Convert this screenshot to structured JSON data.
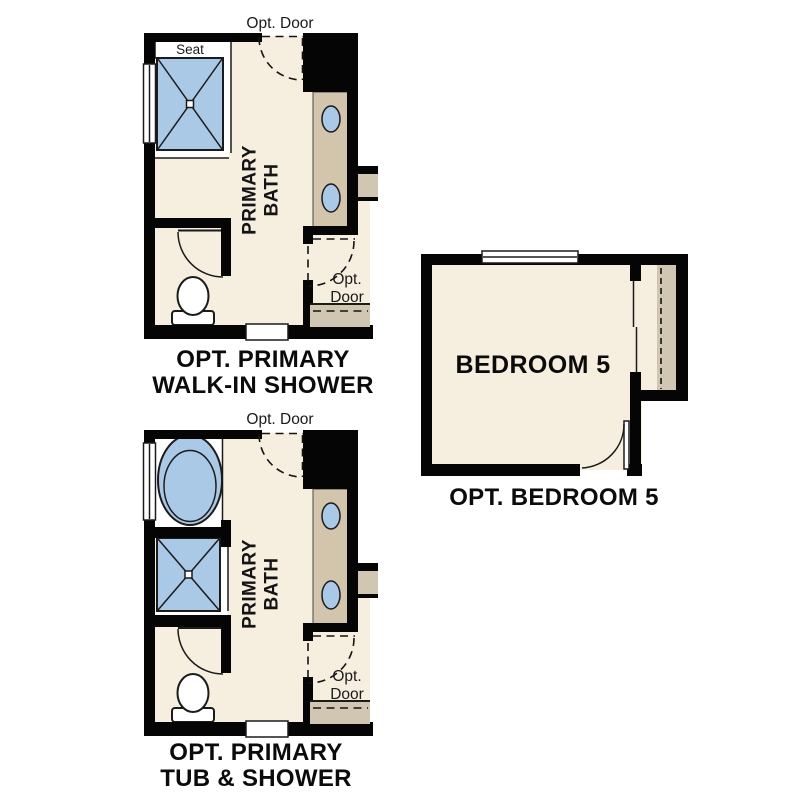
{
  "figure": {
    "type": "floor-plan-options",
    "background": "#ffffff"
  },
  "colors": {
    "wall": "#050505",
    "floor_cream": "#f6eedf",
    "fixture_blue": "#aac9e7",
    "counter_tan": "#d3c4ac",
    "closet_tan": "#d1c6b2",
    "fixture_white": "#ffffff"
  },
  "plans": {
    "walk_in_shower": {
      "caption": [
        "OPT. PRIMARY",
        "WALK-IN SHOWER"
      ],
      "room_label": [
        "PRIMARY",
        "BATH"
      ],
      "seat_label": "Seat",
      "opt_door_top_label": "Opt. Door",
      "opt_door_side_label": [
        "Opt.",
        "Door"
      ]
    },
    "tub_shower": {
      "caption": [
        "OPT. PRIMARY",
        "TUB & SHOWER"
      ],
      "room_label": [
        "PRIMARY",
        "BATH"
      ],
      "opt_door_top_label": "Opt. Door",
      "opt_door_side_label": [
        "Opt.",
        "Door"
      ]
    },
    "bedroom5": {
      "caption": "OPT. BEDROOM 5",
      "room_label": "BEDROOM 5"
    }
  }
}
